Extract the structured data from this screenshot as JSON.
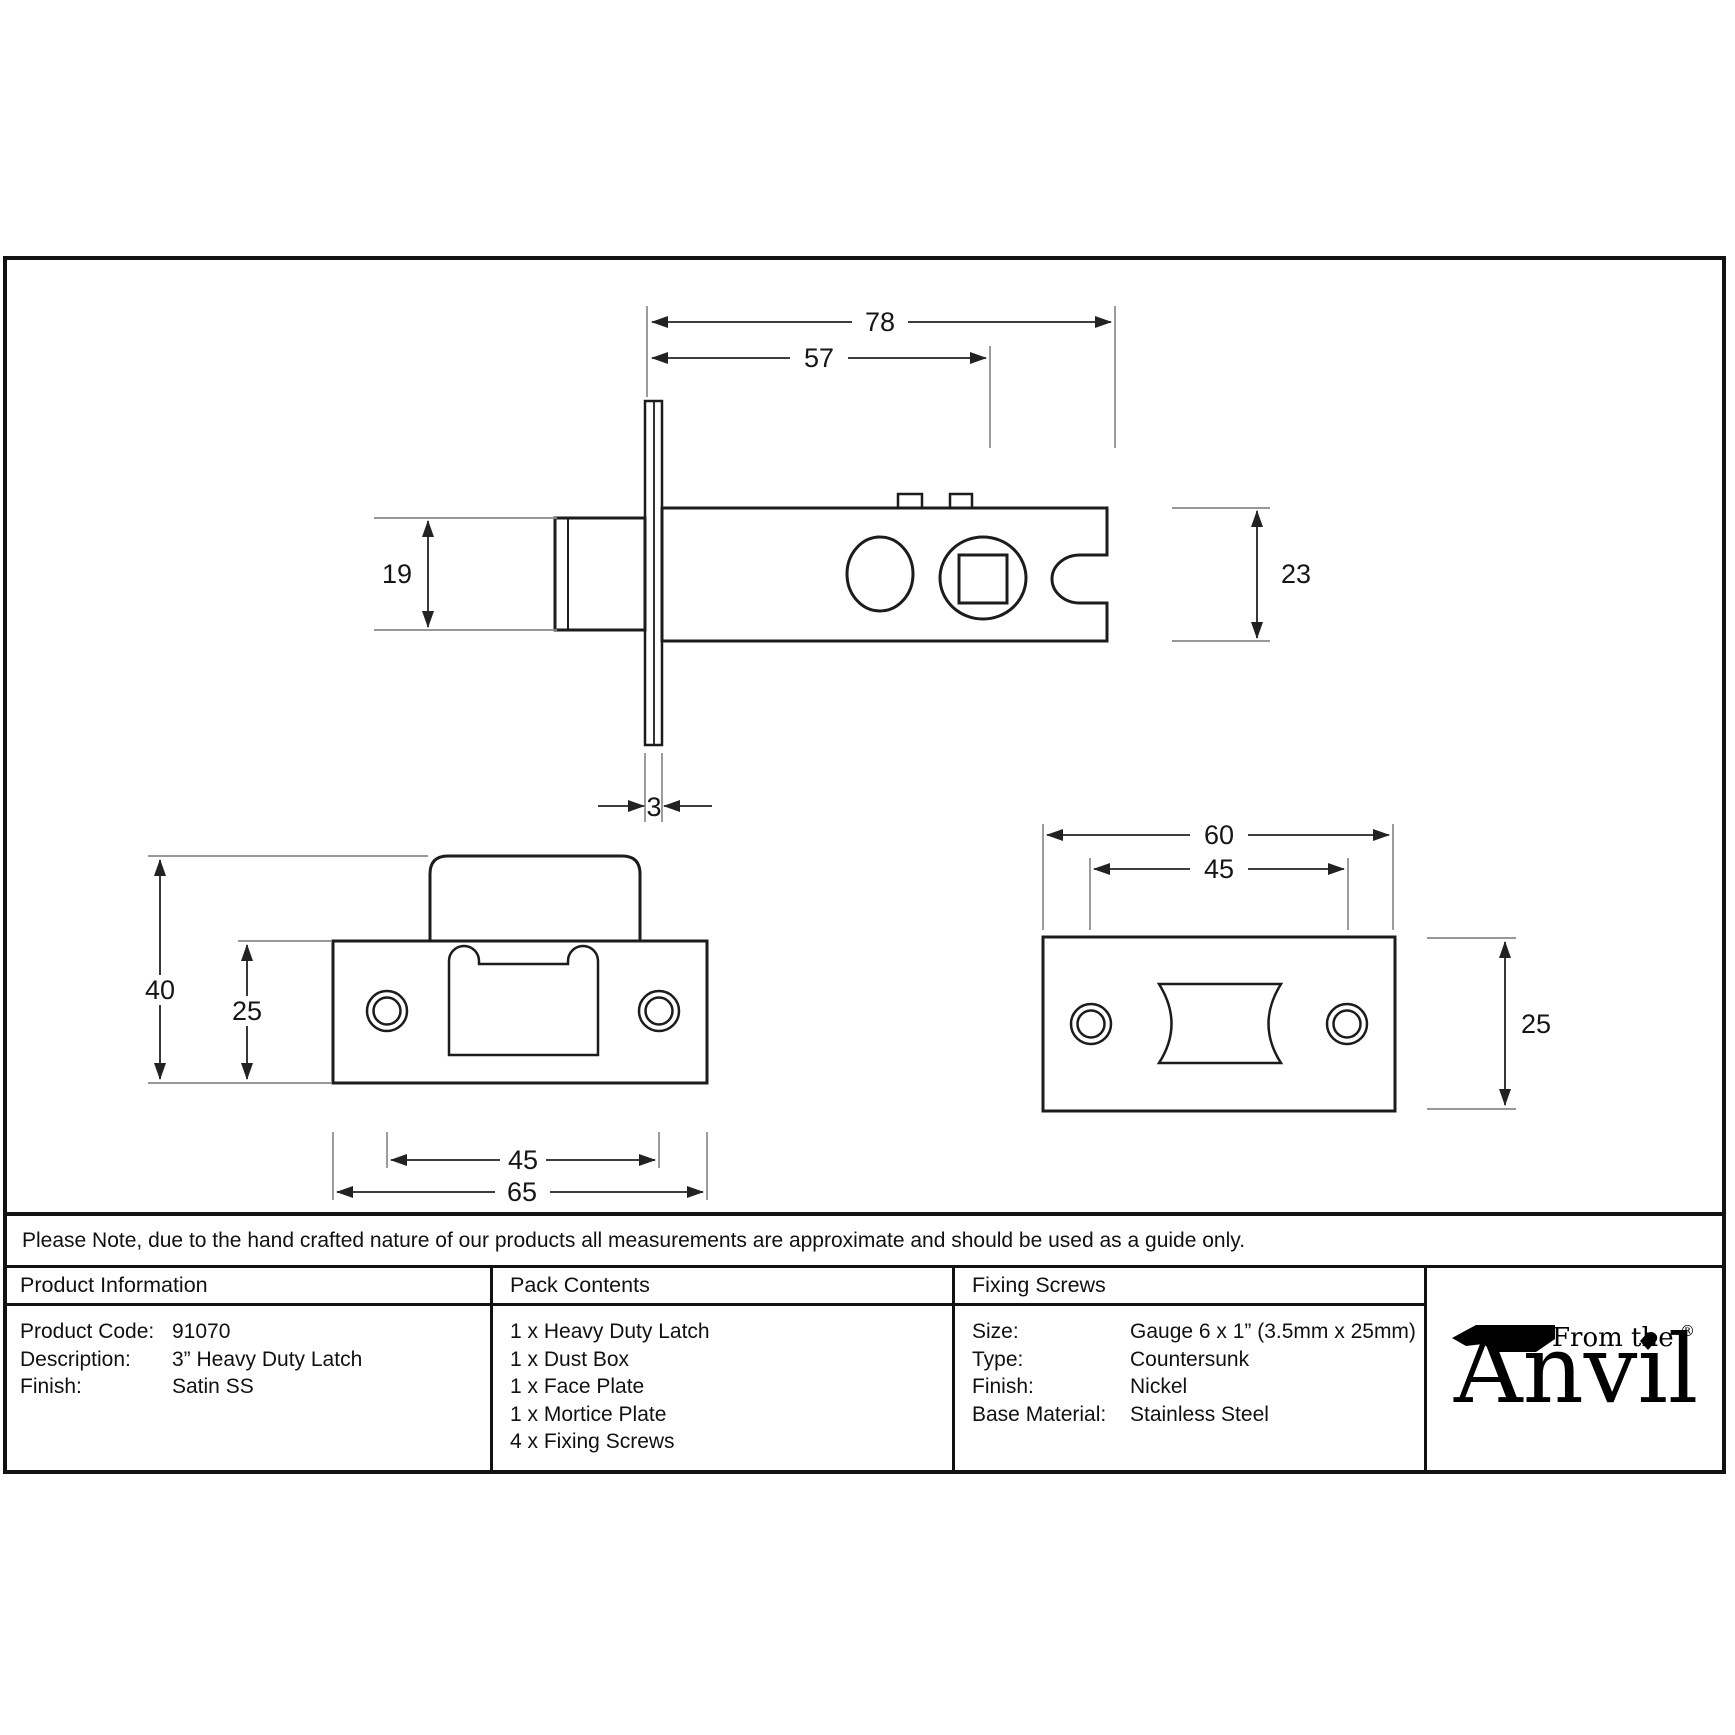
{
  "note": "Please Note, due to the hand crafted nature of our products all measurements are approximate and should be used as a guide only.",
  "table": {
    "product_information": {
      "header": "Product Information",
      "rows": [
        {
          "label": "Product Code:",
          "value": "91070"
        },
        {
          "label": "Description:",
          "value": "3” Heavy Duty Latch"
        },
        {
          "label": "Finish:",
          "value": "Satin SS"
        }
      ]
    },
    "pack_contents": {
      "header": "Pack Contents",
      "items": [
        "1 x Heavy Duty Latch",
        "1 x Dust Box",
        "1 x Face Plate",
        "1 x Mortice Plate",
        "4 x Fixing Screws"
      ]
    },
    "fixing_screws": {
      "header": "Fixing Screws",
      "rows": [
        {
          "label": "Size:",
          "value": "Gauge 6 x 1” (3.5mm x 25mm)"
        },
        {
          "label": "Type:",
          "value": "Countersunk"
        },
        {
          "label": "Finish:",
          "value": "Nickel"
        },
        {
          "label": "Base Material:",
          "value": "Stainless Steel"
        }
      ]
    }
  },
  "logo": {
    "tagline": "From the",
    "name": "Anvil",
    "registered": "®"
  },
  "drawings": {
    "latch_side_view": {
      "dims": {
        "overall_length": "78",
        "case_length": "57",
        "bolt_height": "19",
        "case_height": "23",
        "faceplate_thickness": "3"
      }
    },
    "face_plate_view": {
      "dims": {
        "overall_height": "40",
        "plate_height": "25",
        "hole_spacing": "45",
        "plate_width": "65"
      }
    },
    "mortice_plate_view": {
      "dims": {
        "plate_width": "60",
        "hole_spacing": "45",
        "plate_height": "25"
      }
    }
  }
}
